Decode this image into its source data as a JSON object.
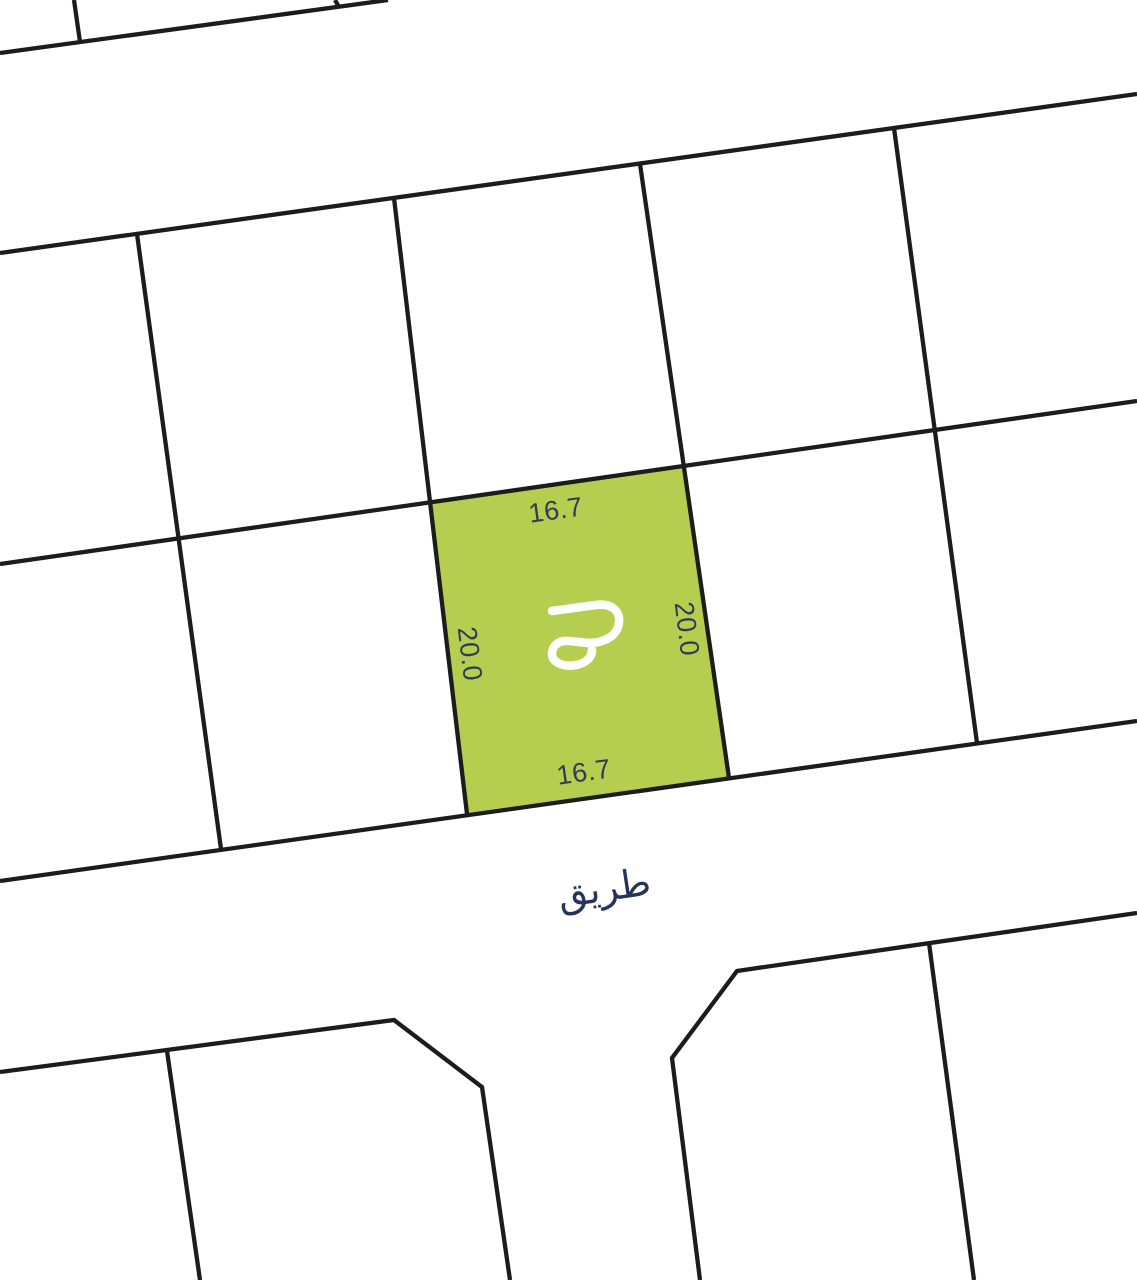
{
  "page": {
    "background": "#ffffff"
  },
  "map": {
    "line_color": "#1c1c1c",
    "label_color": "#2e3d55",
    "road": {
      "label": "طريق",
      "label_color": "#253459"
    },
    "plot": {
      "fill": "#b6ce50",
      "dim_top": "16.7",
      "dim_bottom": "16.7",
      "dim_left": "20.0",
      "dim_right": "20.0",
      "logo_icon": "gp-monogram",
      "logo_color": "#ffffff"
    }
  }
}
